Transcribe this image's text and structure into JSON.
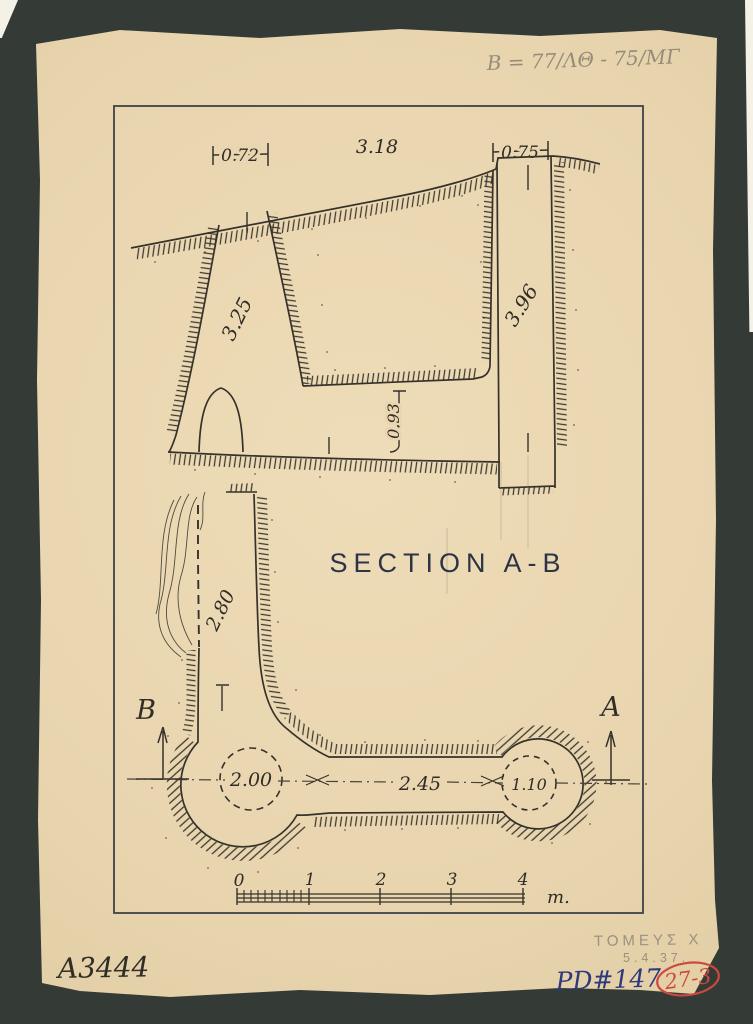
{
  "colors": {
    "background": "#343a36",
    "paper": "#e9d6b0",
    "ink": "#35322b",
    "pencil": "#968c79",
    "blue_ink": "#2c3a7d",
    "red_stamp": "#cf4840"
  },
  "annotations": {
    "top_right_pencil": "B = 77/ΛΘ - 75/ΜΓ",
    "catalog_number": "A3444",
    "pencil_label": "ΤΟΜΕΥΣ Χ",
    "pencil_date": "5.4.37.",
    "inventory_number": "PD#147",
    "red_stamp": "27-3"
  },
  "drawing": {
    "title": "SECTION A-B",
    "section": {
      "dim_top_left": "0.72",
      "dim_top_middle": "3.18",
      "dim_top_right": "0.75",
      "dim_depth_left": "3.25",
      "dim_depth_right": "3.96",
      "dim_floor": "0.93"
    },
    "plan": {
      "dim_dromos_width": "2.80",
      "dim_chamber": "2.00",
      "dim_corridor": "2.45",
      "dim_small_chamber": "1.10",
      "marker_b": "B",
      "marker_a": "A"
    },
    "scale_bar": {
      "ticks": [
        "0",
        "1",
        "2",
        "3",
        "4"
      ],
      "unit": "m."
    }
  }
}
